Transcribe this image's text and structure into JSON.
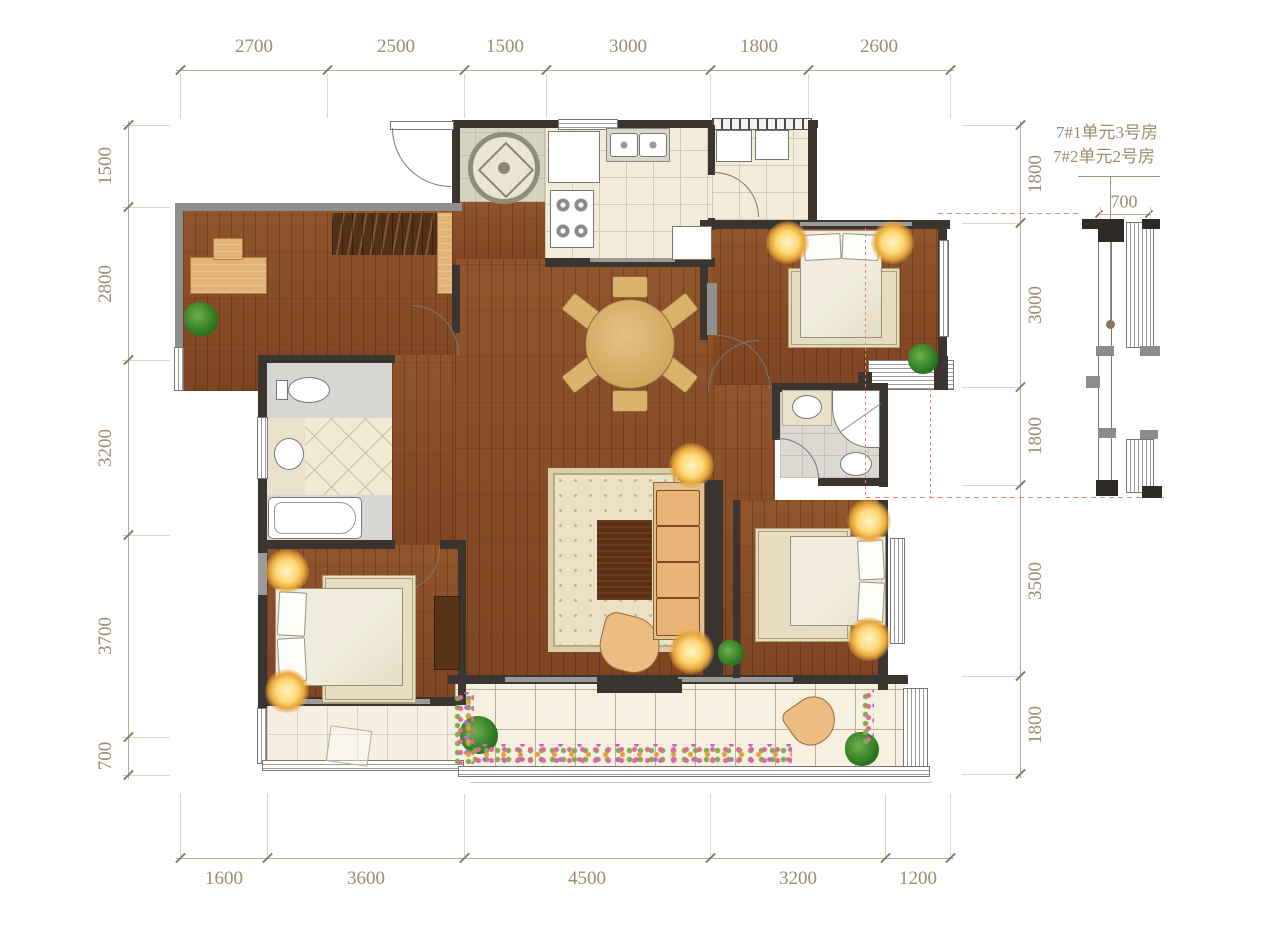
{
  "plan": {
    "dimensions_mm": {
      "top": [
        "2700",
        "2500",
        "1500",
        "3000",
        "1800",
        "2600"
      ],
      "bottom": [
        "1600",
        "3600",
        "4500",
        "3200",
        "1200"
      ],
      "left": [
        "1500",
        "2800",
        "3200",
        "3700",
        "700"
      ],
      "right": [
        "1800",
        "3000",
        "1800",
        "3500",
        "1800"
      ]
    },
    "inset": {
      "label_line1": "7#1单元3号房",
      "label_line2": "7#2单元2号房",
      "width_dim": "700"
    },
    "colors": {
      "dimension_text": "#9d8b74",
      "wall_dark": "#3a3531",
      "wall_gray": "#8f8f8d",
      "wood_floor": "#8a4e28",
      "tile_floor": "#f1ebd8",
      "red_guide": "#e88585",
      "lamp_glow": "#ffd978"
    }
  }
}
